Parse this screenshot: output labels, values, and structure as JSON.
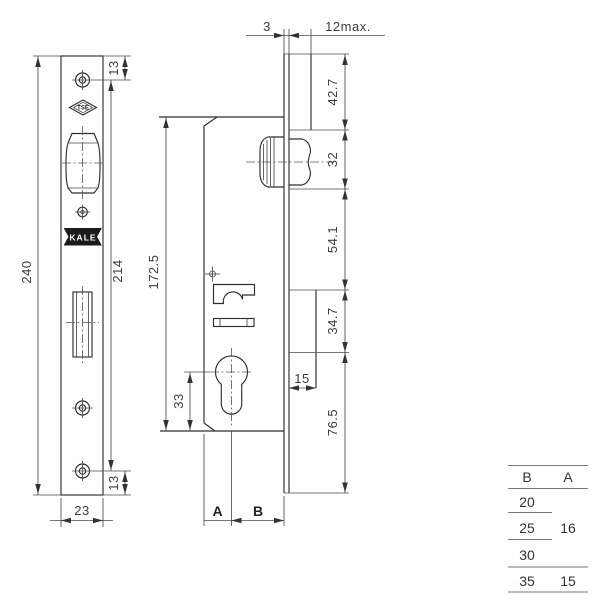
{
  "front_view": {
    "dim_total_height": "240",
    "dim_screw_span": "214",
    "dim_top_screw_offset": "13",
    "dim_bottom_screw_offset": "13",
    "dim_plate_width": "23",
    "tse_logo_text": "TSE",
    "kale_logo_text": "KALE"
  },
  "side_view": {
    "dim_plate_thickness": "3",
    "dim_overlay_max": "12max.",
    "dim_case_height": "172.5",
    "dim_cyl_to_bottom": "33",
    "dim_strike_offset": "15",
    "label_backset_a": "A",
    "label_backset_b": "B",
    "segments": {
      "top": "42.7",
      "roller": "32",
      "mid": "54.1",
      "bolt": "34.7",
      "bottom": "76.5"
    }
  },
  "size_table": {
    "header": {
      "b": "B",
      "a": "A"
    },
    "rows": [
      {
        "b": "20",
        "a": ""
      },
      {
        "b": "25",
        "a": "16"
      },
      {
        "b": "30",
        "a": ""
      },
      {
        "b": "35",
        "a": "15"
      }
    ]
  }
}
